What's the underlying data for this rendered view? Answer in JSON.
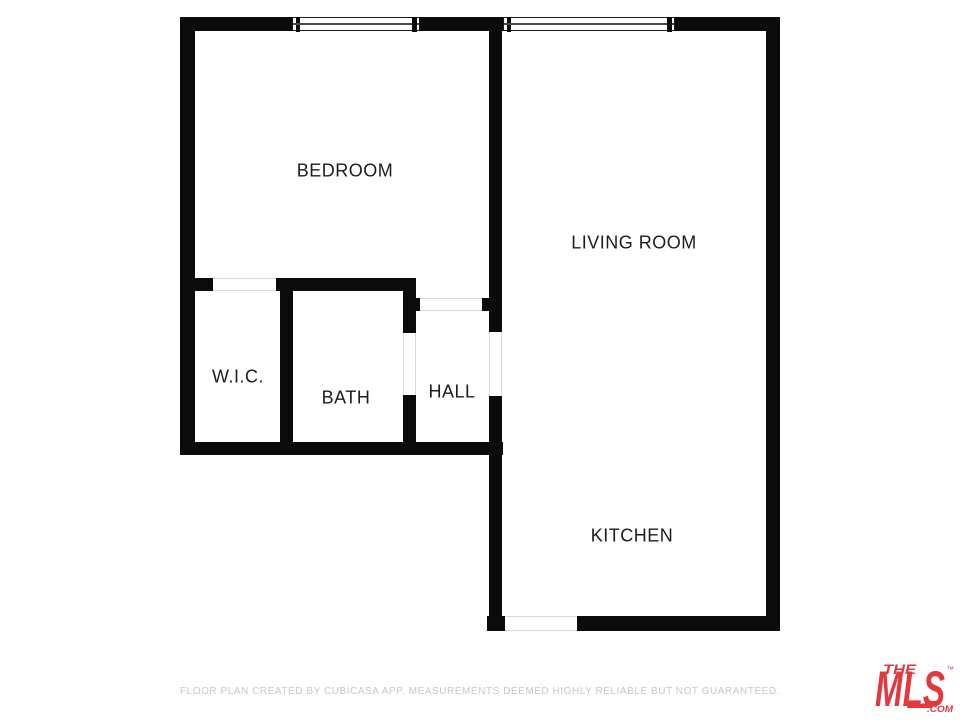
{
  "plan": {
    "type": "floor-plan",
    "rooms": [
      {
        "name": "bedroom",
        "label": "BEDROOM"
      },
      {
        "name": "living-room",
        "label": "LIVING ROOM"
      },
      {
        "name": "wic",
        "label": "W.I.C."
      },
      {
        "name": "bath",
        "label": "BATH"
      },
      {
        "name": "hall",
        "label": "HALL"
      },
      {
        "name": "kitchen",
        "label": "KITCHEN"
      }
    ],
    "windows": 2,
    "door_openings": 5
  },
  "footer": {
    "disclaimer": "FLOOR PLAN CREATED BY CUBICASA APP. MEASUREMENTS DEEMED HIGHLY RELIABLE BUT NOT GUARANTEED."
  },
  "logo": {
    "the": "THE",
    "mls": "MLS",
    "trademark": "™",
    "com": ".COM"
  },
  "colors": {
    "wall": "#0b0b0b",
    "label_text": "#1c1c1c",
    "footer_text": "#c8c8c8",
    "threshold_line": "#d8d8d8",
    "logo_red": "#e2383e",
    "background": "#ffffff"
  }
}
